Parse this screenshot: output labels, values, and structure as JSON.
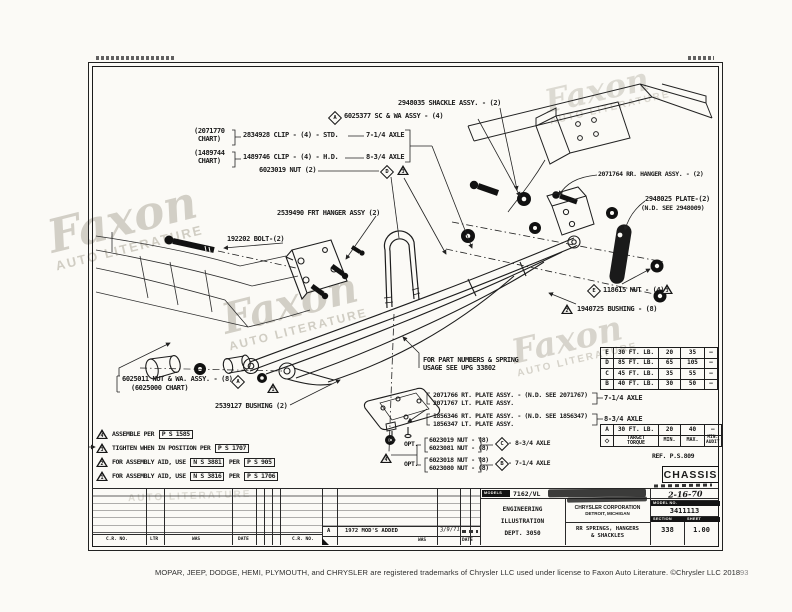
{
  "callouts": {
    "chart1": [
      "(2071770",
      "CHART)"
    ],
    "clip_std": "2834928 CLIP - (4) - STD.",
    "chart2": [
      "(1489744",
      "CHART)"
    ],
    "clip_hd": "1489746 CLIP - (4) - H.D.",
    "axle_714": "7-1/4 AXLE",
    "axle_834": "8-3/4 AXLE",
    "nut_6023019": "6023019 NUT (2)",
    "sc_wa": "6025377 SC & WA ASSY - (4)",
    "shackle": "2948035 SHACKLE ASSY. - (2)",
    "rr_hanger": "2071764 RR. HANGER ASSY. - (2)",
    "plate_2948025": [
      "2948025 PLATE-(2)",
      "(N.D. SEE 2948009)"
    ],
    "nut_118615": "118615 NUT - (4)",
    "bushing_1940725": "1940725 BUSHING - (8)",
    "frt_hanger": "2539490 FRT HANGER ASSY (2)",
    "bolt_192202": "192202 BOLT-(2)",
    "nut_wa_6025011": [
      "6025011 NUT & WA. ASSY. - (8)",
      "(6025000 CHART)"
    ],
    "bushing_2539127": "2539127 BUSHING (2)",
    "spring_note": [
      "FOR PART NUMBERS & SPRING",
      "USAGE SEE UPG 33802"
    ],
    "plate_rt_714": "2071766 RT. PLATE ASSY. - (N.D. SEE 2071767)",
    "plate_lt_714": "2071767 LT. PLATE ASSY.",
    "plate_rt_834": "1856346 RT. PLATE ASSY. - (N.D. SEE 1856347)",
    "plate_lt_834": "1856347 LT. PLATE ASSY.",
    "opt": "OPT.",
    "opt_nut_834": [
      "6023019 NUT - (8)",
      "6023081 NUT - (8)"
    ],
    "opt_nut_714": [
      "6023018 NUT - (8)",
      "6023080 NUT - (8)"
    ],
    "opt_axle_834": "- 8-3/4 AXLE",
    "opt_axle_714": "- 7-1/4 AXLE"
  },
  "symbols": {
    "A": "A",
    "B": "B",
    "C": "C",
    "D": "D",
    "E": "E",
    "t1": "1",
    "t2": "2",
    "t3": "3",
    "t4": "4"
  },
  "notes": [
    {
      "num": "4",
      "prefix": "ASSEMBLE PER",
      "box1": "P S 1585",
      "mid": "",
      "box2": ""
    },
    {
      "num": "3",
      "prefix": "TIGHTEN WHEN IN POSITION PER",
      "box1": "P S 1707",
      "mid": "",
      "box2": ""
    },
    {
      "num": "2",
      "prefix": "FOR ASSEMBLY AID, USE",
      "box1": "N S 3881",
      "mid": "PER",
      "box2": "P S 905"
    },
    {
      "num": "1",
      "prefix": "FOR ASSEMBLY AID, USE",
      "box1": "N S 3816",
      "mid": "PER",
      "box2": "P S 1706"
    }
  ],
  "tables": {
    "upper": [
      [
        "E",
        "30 FT. LB.",
        "20",
        "35"
      ],
      [
        "D",
        "85 FT. LB.",
        "65",
        "105"
      ],
      [
        "C",
        "45 FT. LB.",
        "35",
        "55"
      ],
      [
        "B",
        "40 FT. LB.",
        "30",
        "50"
      ]
    ],
    "lower": [
      "A",
      "30 FT. LB.",
      "20",
      "40"
    ],
    "header": {
      "diamond": "◇",
      "target1": "TARGET",
      "target2": "TORQUE",
      "min": "MIN.",
      "max": "MAX.",
      "audit1": "MIN.",
      "audit2": "AUDIT"
    },
    "dash": "—",
    "ref": "REF. P.S.809"
  },
  "title_block": {
    "chassis": "CHASSIS",
    "date": "2-16-70",
    "models_label": "MODELS",
    "models_value": "7162/VL",
    "dept": [
      "ENGINEERING",
      "ILLUSTRATION",
      "DEPT. 3050"
    ],
    "company": [
      "CHRYSLER CORPORATION",
      "DETROIT, MICHIGAN"
    ],
    "subject": [
      "RR SPRINGS, HANGERS",
      "& SHACKLES"
    ],
    "model_no_label": "MODEL NO.",
    "model_no": "3411113",
    "section_label": "SECTION",
    "section": "338",
    "sheet_label": "SHEET",
    "sheet": "1.00",
    "rev_headers": [
      "C.R. NO.",
      "LTR",
      "WAS",
      "DATE",
      "C.R. NO."
    ],
    "rev_headers2": [
      "WAS",
      "DATE"
    ],
    "revision": {
      "ltr": "A",
      "desc": "1972 MOD'S ADDED",
      "date": "3/9/71"
    }
  },
  "watermark": {
    "word": "Faxon",
    "sub": "AUTO LITERATURE"
  },
  "footer": {
    "caption": "MOPAR, JEEP, DODGE, HEMI, PLYMOUTH, and CHRYSLER are registered trademarks of Chrysler LLC used under license to Faxon Auto Literature. ©Chrysler LLC 2018",
    "page": "93"
  }
}
